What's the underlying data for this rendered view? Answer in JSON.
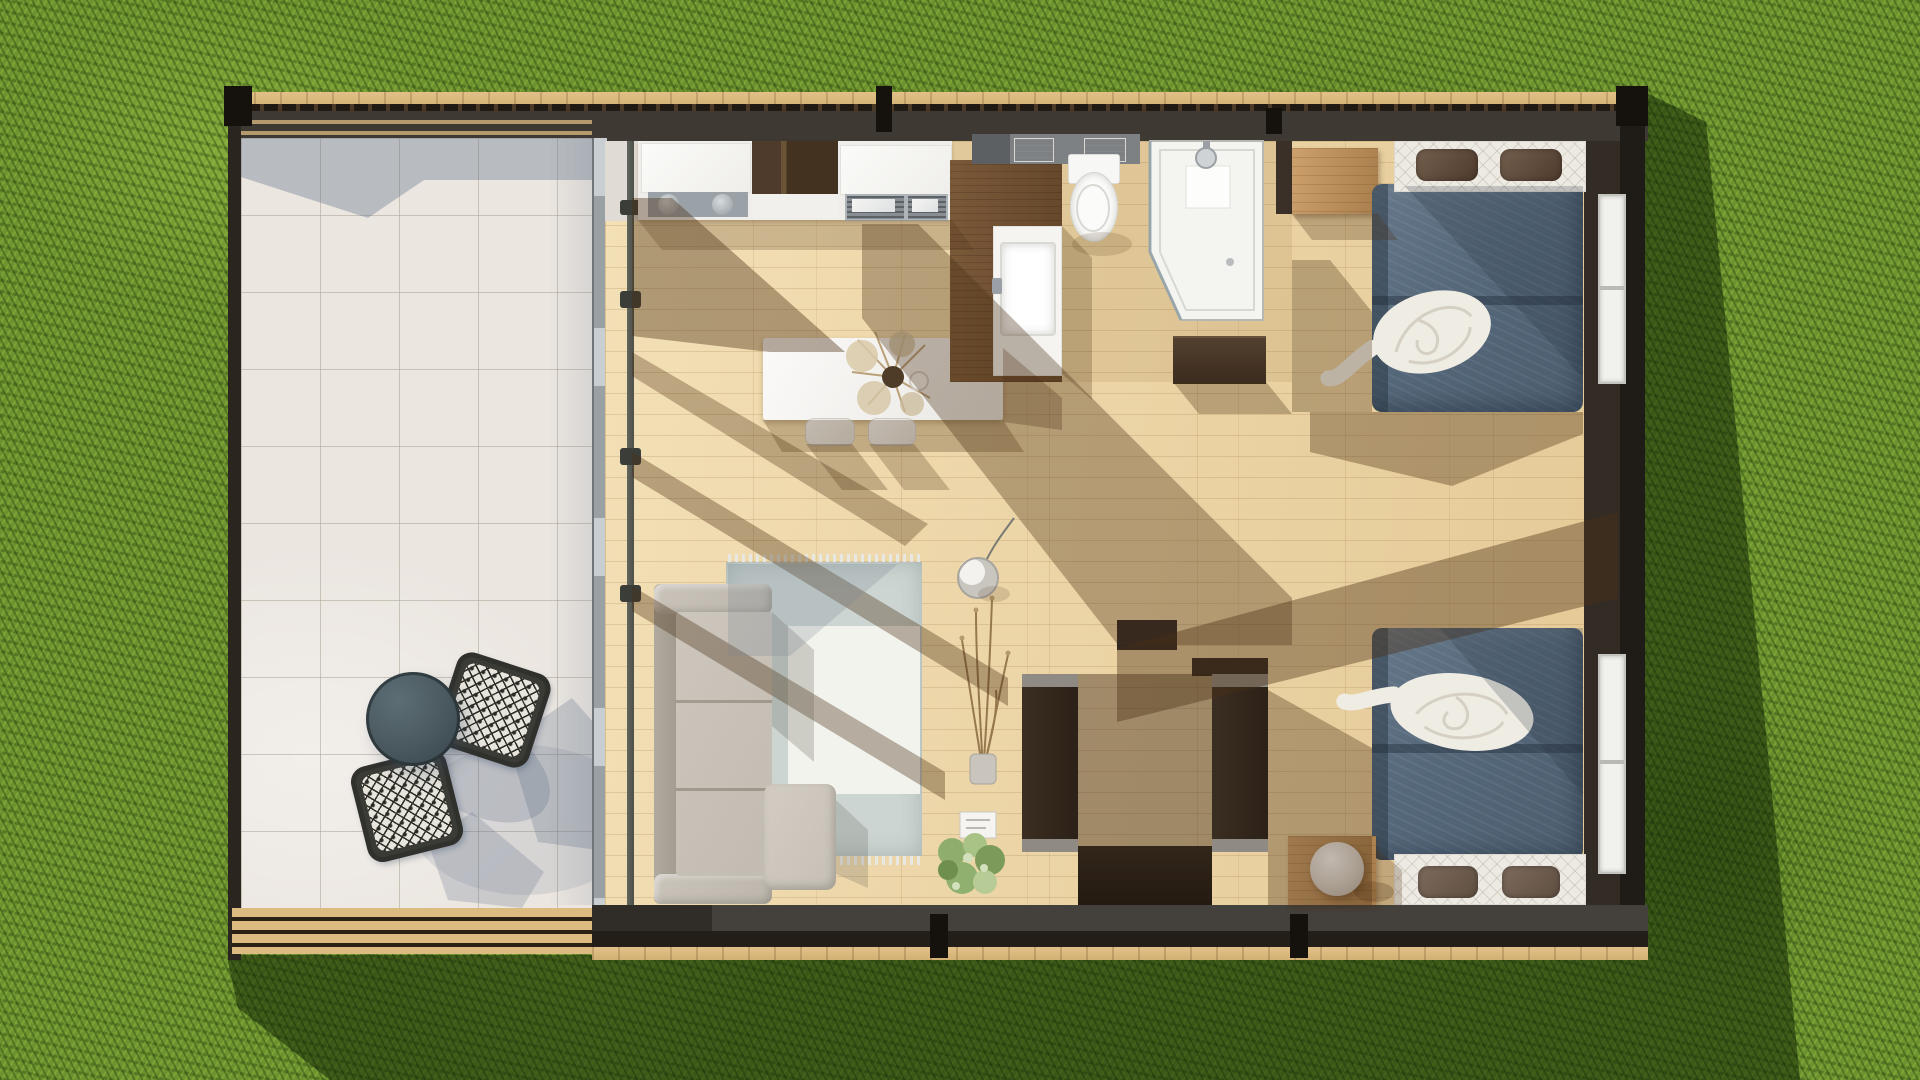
{
  "scene": {
    "name": "tiny-house-top-down-floorplan-render",
    "view": "top-down aerial",
    "setting": "green lawn",
    "lighting": "sunlight from upper-left casting diagonal beam shadows"
  },
  "colors": {
    "grass_base": "#6d9330",
    "grass_shadow_c": "rgba(16,34,4,0.52)",
    "deck_wood": "#dcb97e",
    "wall": "#3f3933",
    "wall_dark": "#211c17",
    "wall_brown": "#2e2722",
    "tile": "#ebe6e0",
    "counter": "#efeeeb",
    "steel": "#9aa2a8",
    "island_white": "#f7f6f3",
    "vanity_wood": "#6e4f33",
    "duvet_blue": "#55687a",
    "headboard": "#edeae3",
    "pillow_brown": "#5e4a3a",
    "sofa_beige": "#c7c1b6",
    "rug": "#cdd5d2",
    "rug_inner": "#f3f3ee",
    "media_cap": "#8f8b84",
    "table_slate": "#49585e",
    "shadow_warm": "#4a2f14",
    "shadow_cool": "#5a6c85"
  },
  "rooms": [
    {
      "id": "patio",
      "label": "tiled patio deck"
    },
    {
      "id": "kitchen",
      "label": "kitchen with counter and island"
    },
    {
      "id": "bathroom",
      "label": "bathroom with shower, toilet, vanity"
    },
    {
      "id": "living",
      "label": "living room with sofa, rug, media wall"
    },
    {
      "id": "bedroom-1",
      "label": "upper bedroom"
    },
    {
      "id": "bedroom-2",
      "label": "lower bedroom"
    }
  ],
  "furniture": [
    {
      "id": "patio-table",
      "room": "patio",
      "label": "round slate bistro table"
    },
    {
      "id": "patio-chair-1",
      "room": "patio",
      "label": "patterned wicker chair upper"
    },
    {
      "id": "patio-chair-2",
      "room": "patio",
      "label": "patterned wicker chair lower"
    },
    {
      "id": "kitchen-counter",
      "room": "kitchen",
      "label": "counter run with sinks, dark cabinet, double basin"
    },
    {
      "id": "kitchen-island",
      "room": "kitchen",
      "label": "white island with dried-flower vase and cup"
    },
    {
      "id": "stool-1",
      "room": "kitchen",
      "label": "island stool"
    },
    {
      "id": "stool-2",
      "room": "kitchen",
      "label": "island stool"
    },
    {
      "id": "vanity",
      "room": "bathroom",
      "label": "wood vanity with white basin"
    },
    {
      "id": "shelf-towels",
      "room": "bathroom",
      "label": "shelf with towels"
    },
    {
      "id": "toilet",
      "room": "bathroom",
      "label": "toilet"
    },
    {
      "id": "shower",
      "room": "bathroom",
      "label": "corner walk-in shower"
    },
    {
      "id": "dresser",
      "room": "bathroom",
      "label": "dark dresser"
    },
    {
      "id": "desk-bedroom-1",
      "room": "bedroom-1",
      "label": "wooden side cabinet"
    },
    {
      "id": "bed-1",
      "room": "bedroom-1",
      "label": "double bed, slate duvet, white throw, two brown pillows"
    },
    {
      "id": "bed-2",
      "room": "bedroom-2",
      "label": "double bed, slate duvet, white throw, two brown pillows"
    },
    {
      "id": "nightstand",
      "room": "bedroom-2",
      "label": "wooden nightstand with sphere lamp"
    },
    {
      "id": "media-cabinet-left",
      "room": "living",
      "label": "dark media cabinet"
    },
    {
      "id": "media-cabinet-right",
      "room": "living",
      "label": "dark media cabinet"
    },
    {
      "id": "media-console",
      "room": "living",
      "label": "low media console"
    },
    {
      "id": "sofa",
      "room": "living",
      "label": "beige sofa with chaise ottoman"
    },
    {
      "id": "rug",
      "room": "living",
      "label": "two-tone area rug with fringe"
    },
    {
      "id": "pendant-lamp",
      "room": "living",
      "label": "dome pendant lamp"
    },
    {
      "id": "dried-plant",
      "room": "living",
      "label": "dried branch arrangement"
    },
    {
      "id": "green-plant",
      "room": "living",
      "label": "potted green plant with book"
    }
  ],
  "fixtures": [
    {
      "id": "window-1",
      "wall": "right",
      "serves": "bedroom-1"
    },
    {
      "id": "window-2",
      "wall": "right",
      "serves": "bedroom-2"
    },
    {
      "id": "glass-wall",
      "wall": "left-interior",
      "serves": "patio to living"
    },
    {
      "id": "structural-post",
      "location": "interior left"
    }
  ]
}
